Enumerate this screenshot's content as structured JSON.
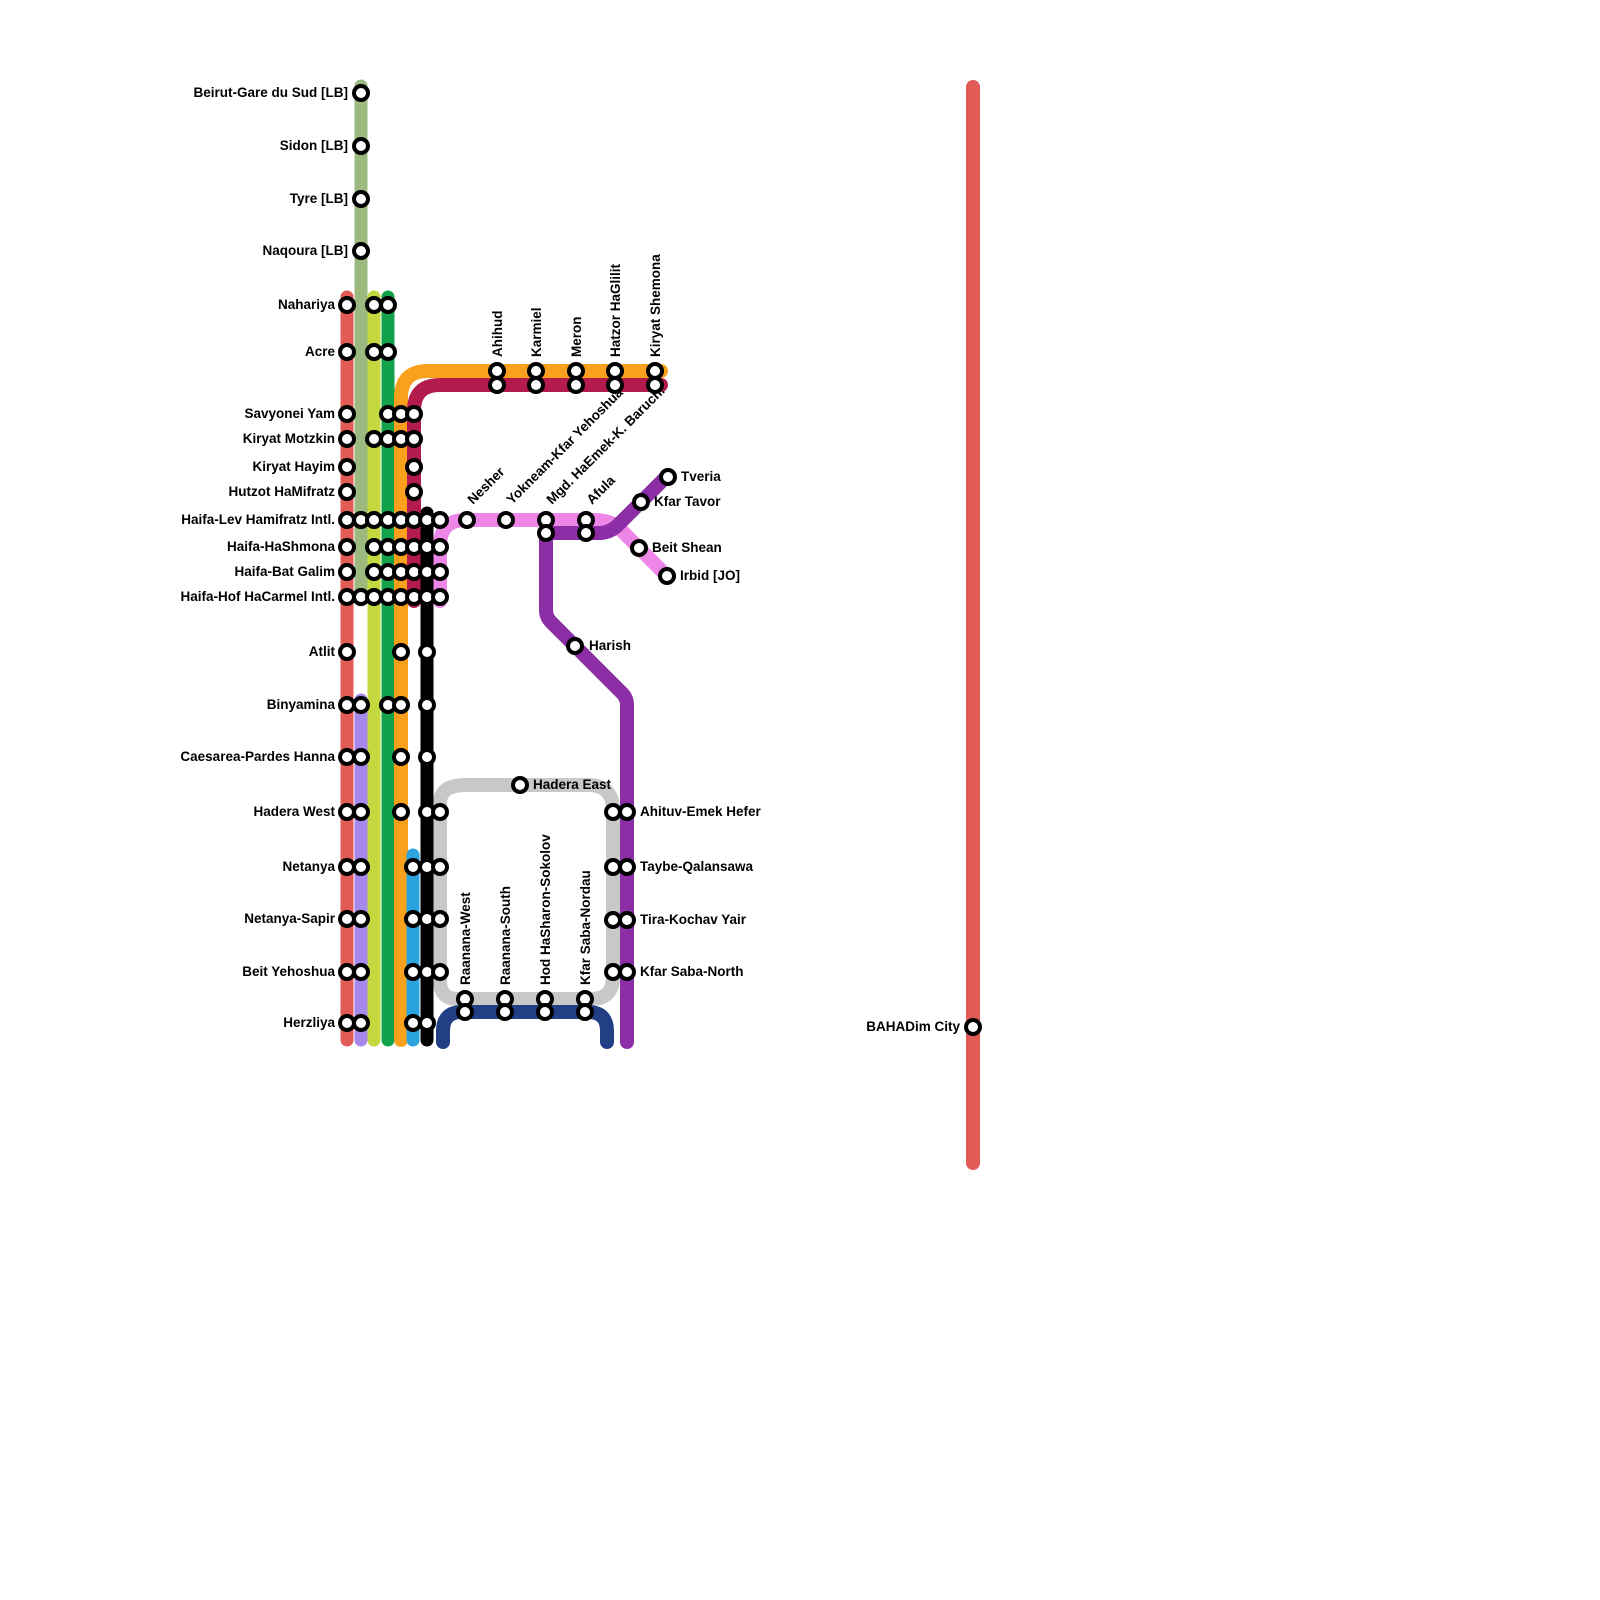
{
  "map": {
    "background": "#ffffff",
    "marker": {
      "radius": 7,
      "fill": "#ffffff",
      "stroke": "#000000",
      "stroke_width": 4
    },
    "lines": [
      {
        "id": "sharon-loop-gray",
        "color": "#c8c8c8",
        "width": 14,
        "d": "M466,785 L588,785 Q613,785 613,810 L613,977 Q613,999 591,999 L458,999 Q440,999 440,981 L440,803 Q440,785 466,785 Z"
      },
      {
        "id": "navy",
        "color": "#223f86",
        "width": 14,
        "d": "M443,1042 L443,1031 Q443,1012 462,1012 L588,1012 Q607,1012 607,1031 L607,1042"
      },
      {
        "id": "pink-valley",
        "color": "#ee86e8",
        "width": 14,
        "d": "M440,601 L440,546 Q440,520 466,520 L594,520 Q611,520 620,529 L668,577"
      },
      {
        "id": "purple-valley",
        "color": "#8c2fa6",
        "width": 14,
        "d": "M668,475 L618,525 Q611,532 601,533 L552,533 Q546,533 546,539 L546,610 Q546,617 551,622 L622,693 Q627,698 627,705 L627,1042"
      },
      {
        "id": "sage-beirut",
        "color": "#9cba80",
        "width": 13,
        "d": "M361,86 L361,600"
      },
      {
        "id": "red-coastal",
        "color": "#e25b54",
        "width": 13,
        "d": "M347,297 L347,1040"
      },
      {
        "id": "lime",
        "color": "#c3d93f",
        "width": 13,
        "d": "M374,297 L374,1040"
      },
      {
        "id": "green",
        "color": "#12a24b",
        "width": 13,
        "d": "M388,297 L388,1040"
      },
      {
        "id": "orange-galilee",
        "color": "#f9a11d",
        "width": 14,
        "d": "M661,371 L428,371 Q401,371 401,398 L401,1040"
      },
      {
        "id": "crimson-galilee",
        "color": "#b31b4d",
        "width": 14,
        "d": "M661,385 L440,385 Q414,385 414,411 L414,601"
      },
      {
        "id": "lavender",
        "color": "#a687ea",
        "width": 13,
        "d": "M361,700 L361,1040"
      },
      {
        "id": "blue",
        "color": "#2ba3dc",
        "width": 13,
        "d": "M413,855 L413,1040"
      },
      {
        "id": "black",
        "color": "#000000",
        "width": 13,
        "d": "M427,513 L427,1040"
      },
      {
        "id": "bahadim-red",
        "color": "#e25b54",
        "width": 14,
        "d": "M973,87 L973,1163"
      }
    ],
    "stations": [
      {
        "label": "Beirut-Gare du Sud [LB]",
        "anchor": "end",
        "rotate": 0,
        "lx": 348,
        "ly": 97,
        "markers": [
          [
            361,
            93
          ]
        ]
      },
      {
        "label": "Sidon [LB]",
        "anchor": "end",
        "rotate": 0,
        "lx": 348,
        "ly": 150,
        "markers": [
          [
            361,
            146
          ]
        ]
      },
      {
        "label": "Tyre [LB]",
        "anchor": "end",
        "rotate": 0,
        "lx": 348,
        "ly": 203,
        "markers": [
          [
            361,
            199
          ]
        ]
      },
      {
        "label": "Naqoura [LB]",
        "anchor": "end",
        "rotate": 0,
        "lx": 348,
        "ly": 255,
        "markers": [
          [
            361,
            251
          ]
        ]
      },
      {
        "label": "Nahariya",
        "anchor": "end",
        "rotate": 0,
        "lx": 335,
        "ly": 309,
        "markers": [
          [
            347,
            305
          ],
          [
            374,
            305
          ],
          [
            388,
            305
          ]
        ]
      },
      {
        "label": "Acre",
        "anchor": "end",
        "rotate": 0,
        "lx": 335,
        "ly": 356,
        "markers": [
          [
            347,
            352
          ],
          [
            374,
            352
          ],
          [
            388,
            352
          ]
        ]
      },
      {
        "label": "Savyonei Yam",
        "anchor": "end",
        "rotate": 0,
        "lx": 335,
        "ly": 418,
        "markers": [
          [
            347,
            414
          ],
          [
            388,
            414
          ],
          [
            401,
            414
          ],
          [
            414,
            414
          ]
        ]
      },
      {
        "label": "Kiryat Motzkin",
        "anchor": "end",
        "rotate": 0,
        "lx": 335,
        "ly": 443,
        "markers": [
          [
            347,
            439
          ],
          [
            374,
            439
          ],
          [
            388,
            439
          ],
          [
            401,
            439
          ],
          [
            414,
            439
          ]
        ]
      },
      {
        "label": "Kiryat Hayim",
        "anchor": "end",
        "rotate": 0,
        "lx": 335,
        "ly": 471,
        "markers": [
          [
            347,
            467
          ],
          [
            414,
            467
          ]
        ]
      },
      {
        "label": "Hutzot HaMifratz",
        "anchor": "end",
        "rotate": 0,
        "lx": 335,
        "ly": 496,
        "markers": [
          [
            347,
            492
          ],
          [
            414,
            492
          ]
        ]
      },
      {
        "label": "Haifa-Lev Hamifratz Intl.",
        "anchor": "end",
        "rotate": 0,
        "lx": 335,
        "ly": 524,
        "markers": [
          [
            347,
            520
          ],
          [
            361,
            520
          ],
          [
            374,
            520
          ],
          [
            388,
            520
          ],
          [
            401,
            520
          ],
          [
            414,
            520
          ],
          [
            427,
            520
          ],
          [
            440,
            520
          ]
        ]
      },
      {
        "label": "Haifa-HaShmona",
        "anchor": "end",
        "rotate": 0,
        "lx": 335,
        "ly": 551,
        "markers": [
          [
            347,
            547
          ],
          [
            374,
            547
          ],
          [
            388,
            547
          ],
          [
            401,
            547
          ],
          [
            414,
            547
          ],
          [
            427,
            547
          ],
          [
            440,
            547
          ]
        ]
      },
      {
        "label": "Haifa-Bat Galim",
        "anchor": "end",
        "rotate": 0,
        "lx": 335,
        "ly": 576,
        "markers": [
          [
            347,
            572
          ],
          [
            374,
            572
          ],
          [
            388,
            572
          ],
          [
            401,
            572
          ],
          [
            414,
            572
          ],
          [
            427,
            572
          ],
          [
            440,
            572
          ]
        ]
      },
      {
        "label": "Haifa-Hof HaCarmel Intl.",
        "anchor": "end",
        "rotate": 0,
        "lx": 335,
        "ly": 601,
        "markers": [
          [
            347,
            597
          ],
          [
            361,
            597
          ],
          [
            374,
            597
          ],
          [
            388,
            597
          ],
          [
            401,
            597
          ],
          [
            414,
            597
          ],
          [
            427,
            597
          ],
          [
            440,
            597
          ]
        ]
      },
      {
        "label": "Atlit",
        "anchor": "end",
        "rotate": 0,
        "lx": 335,
        "ly": 656,
        "markers": [
          [
            347,
            652
          ],
          [
            401,
            652
          ],
          [
            427,
            652
          ]
        ]
      },
      {
        "label": "Binyamina",
        "anchor": "end",
        "rotate": 0,
        "lx": 335,
        "ly": 709,
        "markers": [
          [
            347,
            705
          ],
          [
            361,
            705
          ],
          [
            388,
            705
          ],
          [
            401,
            705
          ],
          [
            427,
            705
          ]
        ]
      },
      {
        "label": "Caesarea-Pardes Hanna",
        "anchor": "end",
        "rotate": 0,
        "lx": 335,
        "ly": 761,
        "markers": [
          [
            347,
            757
          ],
          [
            361,
            757
          ],
          [
            401,
            757
          ],
          [
            427,
            757
          ]
        ]
      },
      {
        "label": "Hadera West",
        "anchor": "end",
        "rotate": 0,
        "lx": 335,
        "ly": 816,
        "markers": [
          [
            347,
            812
          ],
          [
            361,
            812
          ],
          [
            401,
            812
          ],
          [
            427,
            812
          ],
          [
            440,
            812
          ]
        ]
      },
      {
        "label": "Netanya",
        "anchor": "end",
        "rotate": 0,
        "lx": 335,
        "ly": 871,
        "markers": [
          [
            347,
            867
          ],
          [
            361,
            867
          ],
          [
            413,
            867
          ],
          [
            427,
            867
          ],
          [
            440,
            867
          ]
        ]
      },
      {
        "label": "Netanya-Sapir",
        "anchor": "end",
        "rotate": 0,
        "lx": 335,
        "ly": 923,
        "markers": [
          [
            347,
            919
          ],
          [
            361,
            919
          ],
          [
            413,
            919
          ],
          [
            427,
            919
          ],
          [
            440,
            919
          ]
        ]
      },
      {
        "label": "Beit Yehoshua",
        "anchor": "end",
        "rotate": 0,
        "lx": 335,
        "ly": 976,
        "markers": [
          [
            347,
            972
          ],
          [
            361,
            972
          ],
          [
            413,
            972
          ],
          [
            427,
            972
          ],
          [
            440,
            972
          ]
        ]
      },
      {
        "label": "Herzliya",
        "anchor": "end",
        "rotate": 0,
        "lx": 335,
        "ly": 1027,
        "markers": [
          [
            347,
            1023
          ],
          [
            361,
            1023
          ],
          [
            413,
            1023
          ],
          [
            427,
            1023
          ]
        ]
      },
      {
        "label": "Ahihud",
        "anchor": "start",
        "rotate": -90,
        "lx": 502,
        "ly": 357,
        "markers": [
          [
            497,
            371
          ],
          [
            497,
            385
          ]
        ]
      },
      {
        "label": "Karmiel",
        "anchor": "start",
        "rotate": -90,
        "lx": 541,
        "ly": 357,
        "markers": [
          [
            536,
            371
          ],
          [
            536,
            385
          ]
        ]
      },
      {
        "label": "Meron",
        "anchor": "start",
        "rotate": -90,
        "lx": 581,
        "ly": 357,
        "markers": [
          [
            576,
            371
          ],
          [
            576,
            385
          ]
        ]
      },
      {
        "label": "Hatzor HaGlilit",
        "anchor": "start",
        "rotate": -90,
        "lx": 620,
        "ly": 357,
        "markers": [
          [
            615,
            371
          ],
          [
            615,
            385
          ]
        ]
      },
      {
        "label": "Kiryat Shemona",
        "anchor": "start",
        "rotate": -90,
        "lx": 660,
        "ly": 357,
        "markers": [
          [
            655,
            371
          ],
          [
            655,
            385
          ]
        ]
      },
      {
        "label": "Nesher",
        "anchor": "start",
        "rotate": -45,
        "lx": 473,
        "ly": 505,
        "markers": [
          [
            467,
            520
          ]
        ]
      },
      {
        "label": "Yokneam-Kfar Yehoshua",
        "anchor": "start",
        "rotate": -45,
        "lx": 512,
        "ly": 505,
        "markers": [
          [
            506,
            520
          ]
        ]
      },
      {
        "label": "Mgd. HaEmek-K. Baruch.",
        "anchor": "start",
        "rotate": -45,
        "lx": 552,
        "ly": 505,
        "markers": [
          [
            546,
            520
          ],
          [
            546,
            533
          ]
        ]
      },
      {
        "label": "Afula",
        "anchor": "start",
        "rotate": -45,
        "lx": 592,
        "ly": 505,
        "markers": [
          [
            586,
            520
          ],
          [
            586,
            533
          ]
        ]
      },
      {
        "label": "Tveria",
        "anchor": "start",
        "rotate": 0,
        "lx": 681,
        "ly": 481,
        "markers": [
          [
            668,
            477
          ]
        ]
      },
      {
        "label": "Kfar Tavor",
        "anchor": "start",
        "rotate": 0,
        "lx": 654,
        "ly": 506,
        "markers": [
          [
            641,
            502
          ]
        ]
      },
      {
        "label": "Beit Shean",
        "anchor": "start",
        "rotate": 0,
        "lx": 652,
        "ly": 552,
        "markers": [
          [
            639,
            548
          ]
        ]
      },
      {
        "label": "Irbid [JO]",
        "anchor": "start",
        "rotate": 0,
        "lx": 680,
        "ly": 580,
        "markers": [
          [
            667,
            576
          ]
        ]
      },
      {
        "label": "Harish",
        "anchor": "start",
        "rotate": 0,
        "lx": 589,
        "ly": 650,
        "markers": [
          [
            575,
            646
          ]
        ]
      },
      {
        "label": "Hadera East",
        "anchor": "start",
        "rotate": 0,
        "lx": 533,
        "ly": 789,
        "markers": [
          [
            520,
            785
          ]
        ]
      },
      {
        "label": "Ahituv-Emek Hefer",
        "anchor": "start",
        "rotate": 0,
        "lx": 640,
        "ly": 816,
        "markers": [
          [
            613,
            812
          ],
          [
            627,
            812
          ]
        ]
      },
      {
        "label": "Taybe-Qalansawa",
        "anchor": "start",
        "rotate": 0,
        "lx": 640,
        "ly": 871,
        "markers": [
          [
            613,
            867
          ],
          [
            627,
            867
          ]
        ]
      },
      {
        "label": "Tira-Kochav Yair",
        "anchor": "start",
        "rotate": 0,
        "lx": 640,
        "ly": 924,
        "markers": [
          [
            613,
            920
          ],
          [
            627,
            920
          ]
        ]
      },
      {
        "label": "Kfar Saba-North",
        "anchor": "start",
        "rotate": 0,
        "lx": 640,
        "ly": 976,
        "markers": [
          [
            613,
            972
          ],
          [
            627,
            972
          ]
        ]
      },
      {
        "label": "Raanana-West",
        "anchor": "start",
        "rotate": -90,
        "lx": 470,
        "ly": 985,
        "markers": [
          [
            465,
            999
          ],
          [
            465,
            1012
          ]
        ]
      },
      {
        "label": "Raanana-South",
        "anchor": "start",
        "rotate": -90,
        "lx": 510,
        "ly": 985,
        "markers": [
          [
            505,
            999
          ],
          [
            505,
            1012
          ]
        ]
      },
      {
        "label": "Hod HaSharon-Sokolov",
        "anchor": "start",
        "rotate": -90,
        "lx": 550,
        "ly": 985,
        "markers": [
          [
            545,
            999
          ],
          [
            545,
            1012
          ]
        ]
      },
      {
        "label": "Kfar Saba-Nordau",
        "anchor": "start",
        "rotate": -90,
        "lx": 590,
        "ly": 985,
        "markers": [
          [
            585,
            999
          ],
          [
            585,
            1012
          ]
        ]
      },
      {
        "label": "BAHADim City",
        "anchor": "end",
        "rotate": 0,
        "lx": 960,
        "ly": 1031,
        "markers": [
          [
            973,
            1027
          ]
        ]
      }
    ]
  }
}
